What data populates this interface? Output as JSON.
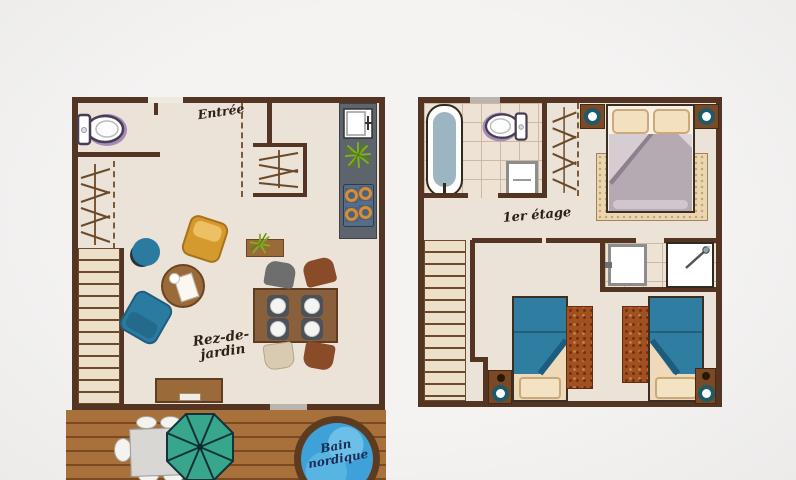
{
  "canvas": {
    "background": "#f2f1f0",
    "type": "hand-drawn chalet floor plan, two levels"
  },
  "ground_floor": {
    "entry_label": "Entrée",
    "level_label": [
      "Rez-de-",
      "jardin"
    ],
    "furniture": [
      "toilet",
      "wardrobe-hangers",
      "entry-closet-hangers",
      "staircase",
      "kitchen-counter",
      "kitchen-sink",
      "hob-4-burners",
      "plant",
      "yellow-armchair",
      "teal-footstool",
      "round-coffee-table",
      "teal-sofa-chair",
      "plant-shelf",
      "dining-table-4-plates",
      "four-chairs",
      "sideboard"
    ]
  },
  "first_floor": {
    "level_label": "1er étage",
    "furniture": [
      "bathtub",
      "toilet",
      "washbasin-cabinet",
      "wardrobe-hangers",
      "double-bed",
      "two-pillows",
      "bedside-tables-with-lamps",
      "bedroom-rug",
      "staircase",
      "shower",
      "washbasin-cabinet",
      "single-bed-left",
      "single-bed-right",
      "rust-rugs",
      "bedside-tables-with-lamps"
    ]
  },
  "terrace": {
    "hot_tub_label": [
      "Bain",
      "nordique"
    ],
    "furniture": [
      "outdoor-table",
      "outdoor-chairs",
      "parasol",
      "hot-tub"
    ]
  },
  "colors": {
    "wall": "#543523",
    "floor": "#ebe2d8",
    "deck_wood": "#a8713c",
    "teal_furniture": "#2b7ba0",
    "parasol_green": "#38a68b",
    "hot_tub_water": "#3ea2d9",
    "rust_rug": "#a0511f",
    "duvet_gray": "#b5aab2",
    "armchair_yellow": "#d59a2e",
    "kitchen_counter": "#5d646b",
    "burner_orange": "#d88e2e"
  }
}
